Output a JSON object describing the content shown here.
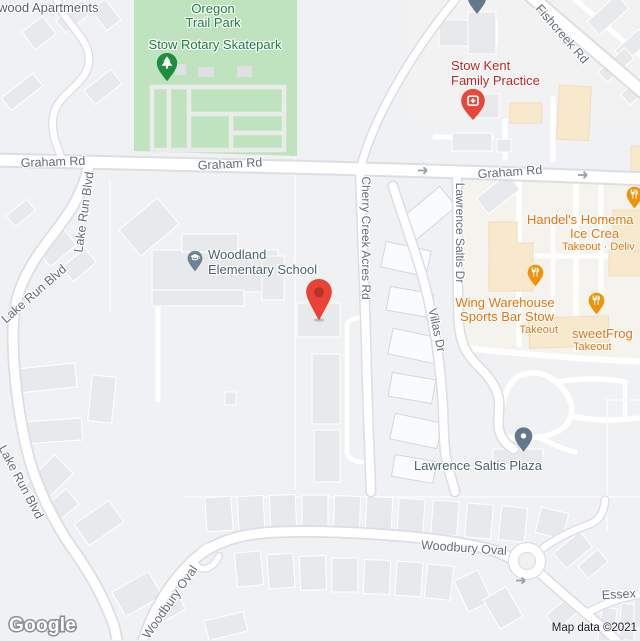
{
  "branding": {
    "logo": "Google"
  },
  "attribution": {
    "text": "Map data ©2021"
  },
  "roads": {
    "graham": "Graham Rd",
    "fishcreek": "Fishcreek Rd",
    "lake_run": "Lake Run Blvd",
    "cherry_creek": "Cherry Creek Acres Rd",
    "lawrence_saltis_dr": "Lawrence Saltis Dr",
    "villas": "Villas Dr",
    "woodbury": "Woodbury Oval",
    "essex": "Essex C"
  },
  "places": {
    "apartments": {
      "name": "wood Apartments"
    },
    "park": {
      "name_line1": "Oregon",
      "name_line2": "Trail Park"
    },
    "skatepark": {
      "name": "Stow Rotary Skatepark"
    },
    "medical": {
      "name_line1": "Stow Kent",
      "name_line2": "Family Practice"
    },
    "school": {
      "name_line1": "Woodland",
      "name_line2": "Elementary School"
    },
    "handels": {
      "name_line1": "Handel's Homema",
      "name_line2": "Ice Crea",
      "services": "Takeout · Deliv"
    },
    "wing": {
      "name_line1": "Wing Warehouse",
      "name_line2": "Sports Bar Stow",
      "services": "Takeout"
    },
    "sweetfrog": {
      "name": "sweetFrog",
      "services": "Takeout"
    },
    "plaza": {
      "name": "Lawrence Saltis Plaza"
    }
  },
  "colors": {
    "park_green_fill": "#BFE3BF",
    "park_label_green": "#188038",
    "medical_red": "#C5221F",
    "restaurant_orange": "#E8710A",
    "food_pin_orange": "#F09309",
    "civic_slate": "#4C6270",
    "destination_marker_red": "#EA4335",
    "road_label_gray": "#666D74",
    "commercial_building_peach": "#F8E8CC"
  }
}
